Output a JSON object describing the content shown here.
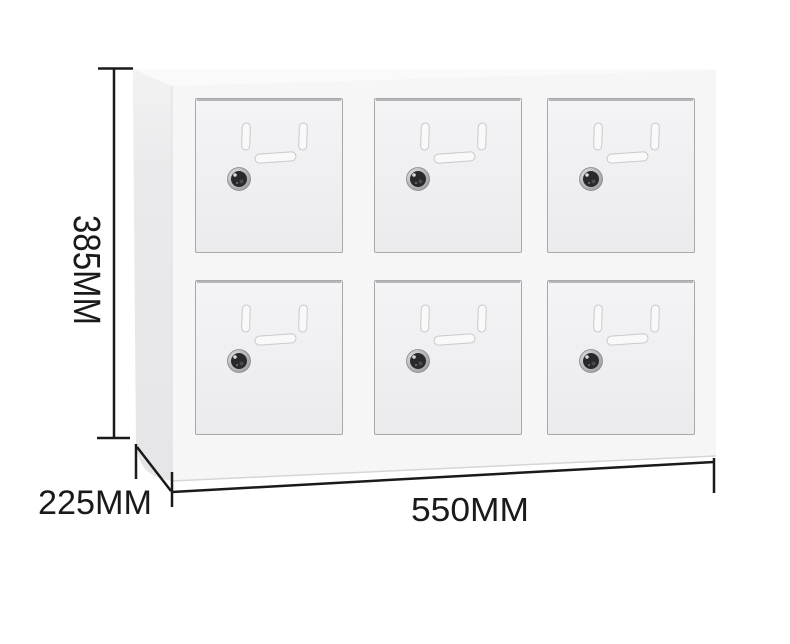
{
  "image": {
    "description": "White six-door metal storage locker cabinet shown in three-quarter view with measurement annotations",
    "background_color": "#ffffff"
  },
  "cabinet": {
    "rows": 2,
    "columns": 3,
    "door_count": 6,
    "door_features": {
      "vertical_vent_slots": 2,
      "horizontal_vent_slot": 1,
      "lock": "round cam lock"
    },
    "colors": {
      "front_frame": "#f6f6f7",
      "door_face": "#f1f1f3",
      "side_panel": "#e9e9eb",
      "top_edge": "#fafafa",
      "door_edge_line": "#a8a8ab",
      "vent_slot_fill": "#f9f9fa",
      "lock_body": "#29292d",
      "lock_rim": "#b9b9bc"
    }
  },
  "dimensions": {
    "height": "385MM",
    "depth": "225MM",
    "width": "550MM",
    "line_color": "#1a1a1a",
    "text_color": "#1a1a1a"
  }
}
